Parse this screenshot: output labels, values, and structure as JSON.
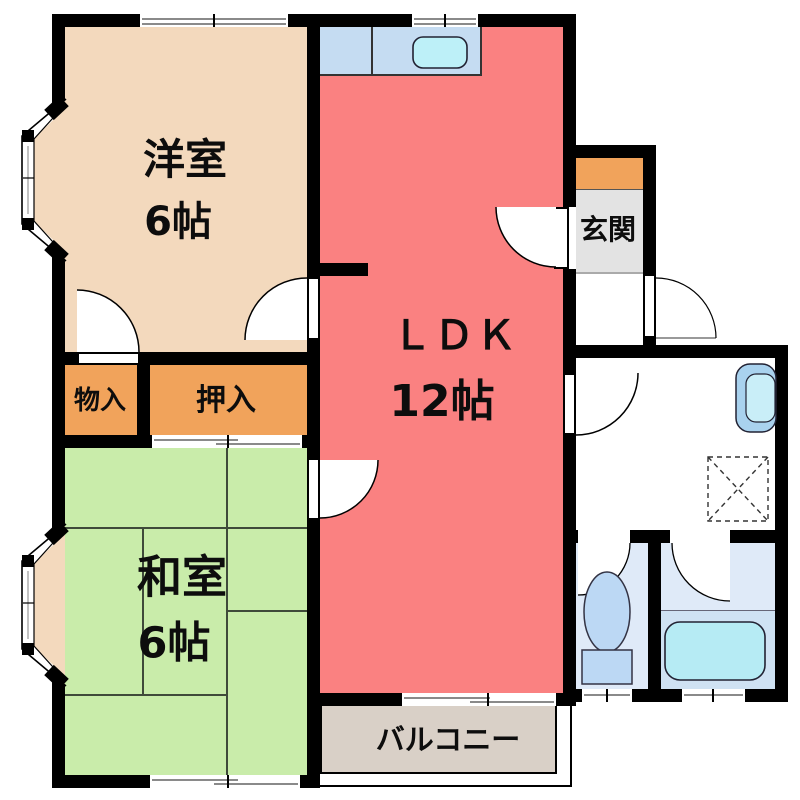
{
  "rooms": {
    "western": {
      "name": "洋室",
      "size": "6帖"
    },
    "ldk": {
      "name": "ＬＤＫ",
      "size": "12帖"
    },
    "japanese": {
      "name": "和室",
      "size": "6帖"
    },
    "storage": {
      "name": "物入"
    },
    "closet": {
      "name": "押入"
    },
    "entrance": {
      "name": "玄関"
    },
    "balcony": {
      "name": "バルコニー"
    }
  },
  "colors": {
    "wall": "#000000",
    "western_room": "#f3d9bd",
    "ldk": "#fa8181",
    "japanese_room": "#c9ecaa",
    "storage": "#f1a35b",
    "entrance_floor": "#e3e3e3",
    "balcony": "#d9d0c7",
    "kitchen_counter": "#c5dcf2",
    "kitchen_sink": "#bdf0f8",
    "wet_room": "#dfeaf8",
    "bathtub": "#b6ebf4",
    "toilet_fixture": "#bcd8f4",
    "washbasin": "#a9d2ee",
    "text": "#0d0d0d"
  }
}
